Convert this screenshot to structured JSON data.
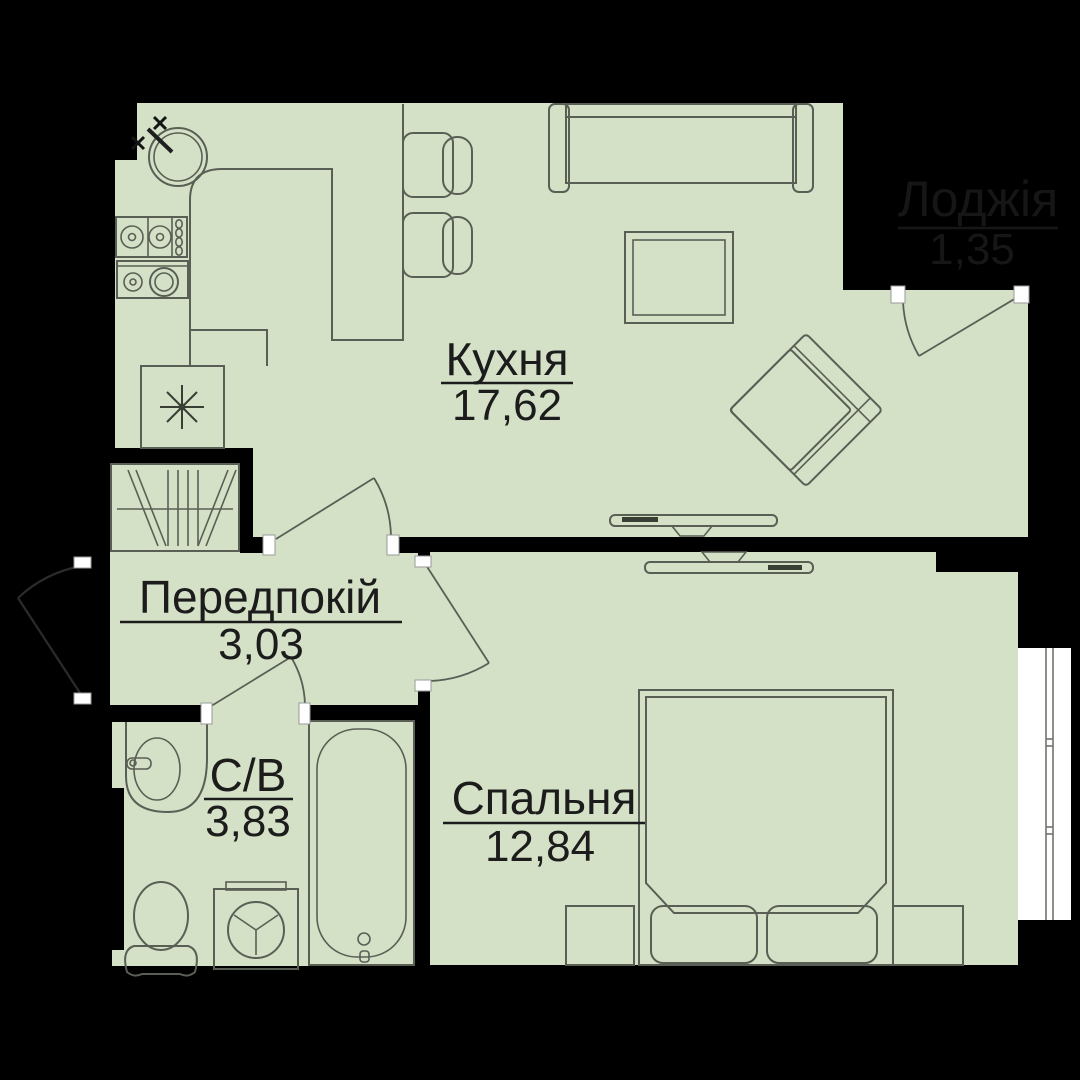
{
  "plan_title": "1-room apartment floor plan",
  "colors": {
    "background": "#000000",
    "floor": "#d4e1c6",
    "furniture_line": "#5a5f55",
    "label_text": "#1c1c1c",
    "loggia_text": "#161616",
    "jamb": "#ffffff",
    "window_line": "#6f756a",
    "tv_accent": "#3a3f36"
  },
  "rooms": [
    {
      "id": "kitchen",
      "name": "Кухня",
      "area": "17,62"
    },
    {
      "id": "hallway",
      "name": "Передпокій",
      "area": "3,03"
    },
    {
      "id": "bathroom",
      "name": "С/В",
      "area": "3,83"
    },
    {
      "id": "bedroom",
      "name": "Спальня",
      "area": "12,84"
    },
    {
      "id": "loggia",
      "name": "Лоджія",
      "area": "1,35"
    }
  ],
  "furniture_icons": [
    "kitchen-sink-icon",
    "faucet-icon",
    "stove-hob-icon",
    "oven-icon",
    "fridge-icon",
    "bar-counter-icon",
    "bar-chair-icon",
    "sofa-icon",
    "coffee-table-icon",
    "armchair-icon",
    "tv-icon",
    "wardrobe-icon",
    "bed-icon",
    "pillow-icon",
    "nightstand-icon",
    "washbasin-icon",
    "toilet-icon",
    "washing-machine-icon",
    "bathtub-icon",
    "window-icon",
    "door-swing-icon"
  ]
}
